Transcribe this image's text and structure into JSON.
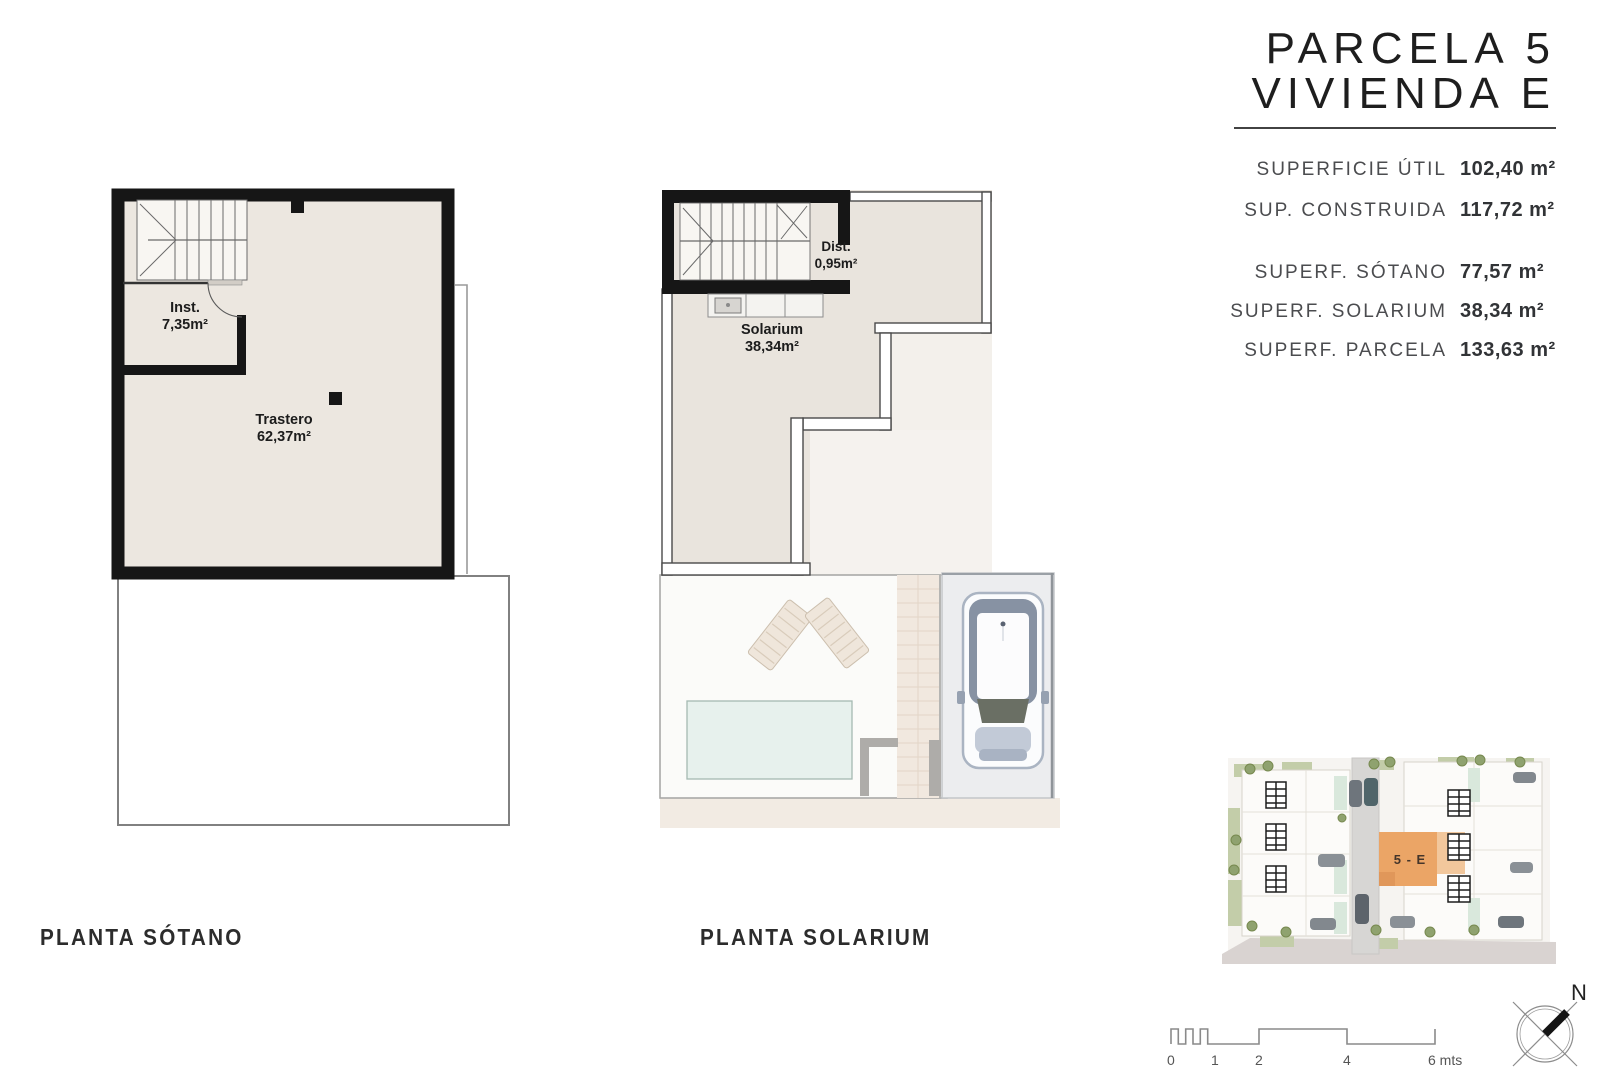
{
  "title": {
    "line1": "PARCELA 5",
    "line2": "VIVIENDA E"
  },
  "specs": {
    "rows": [
      {
        "label": "SUPERFICIE ÚTIL",
        "value": "102,40 m²"
      },
      {
        "label": "SUP. CONSTRUIDA",
        "value": "117,72 m²"
      },
      {
        "label": "SUPERF. SÓTANO",
        "value": "77,57 m²"
      },
      {
        "label": "SUPERF. SOLARIUM",
        "value": "38,34 m²"
      },
      {
        "label": "SUPERF. PARCELA",
        "value": "133,63 m²"
      }
    ]
  },
  "plans": {
    "basement": {
      "caption": "PLANTA SÓTANO",
      "rooms": {
        "inst": {
          "name": "Inst.",
          "area": "7,35m²"
        },
        "trastero": {
          "name": "Trastero",
          "area": "62,37m²"
        }
      }
    },
    "solarium": {
      "caption": "PLANTA SOLARIUM",
      "rooms": {
        "dist": {
          "name": "Dist.",
          "area": "0,95m²"
        },
        "solarium": {
          "name": "Solarium",
          "area": "38,34m²"
        }
      }
    }
  },
  "siteplan": {
    "highlight_label": "5 - E"
  },
  "scalebar": {
    "ticks": [
      "0",
      "1",
      "2",
      "4",
      "6 mts"
    ]
  },
  "compass": {
    "north_label": "N"
  },
  "colors": {
    "wall": "#161616",
    "floor_beige": "#e9e4dd",
    "floor_light": "#f4f1ec",
    "pool_blue": "#e7f1ed",
    "highlight_orange": "#eba566",
    "street_tan": "#f2ebe3"
  }
}
